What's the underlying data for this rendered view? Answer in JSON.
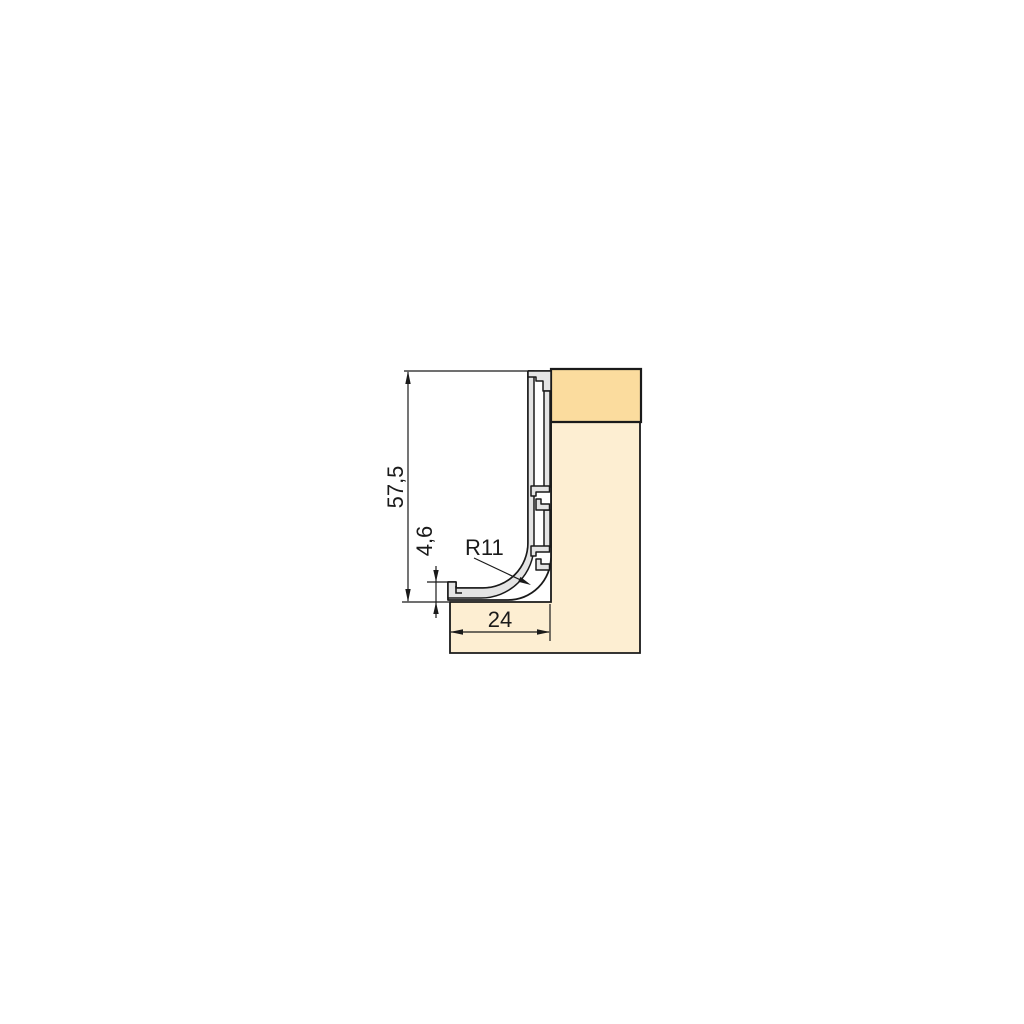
{
  "drawing": {
    "kind": "technical cross-section of handle-less gola profile mounted on cabinet panel",
    "dimensions": {
      "overall_height_mm": "57,5",
      "front_lip_height_mm": "4,6",
      "corner_radius_mm": "R11",
      "bottom_depth_mm": "24"
    }
  },
  "colors": {
    "background": "#ffffff",
    "panel_fill": "#FDEED2",
    "panel_top_fill": "#FBDC9E",
    "profile_fill": "#E4E4E4",
    "profile_inner_fill": "#FFFFFF",
    "outline": "#1A1A1A"
  }
}
